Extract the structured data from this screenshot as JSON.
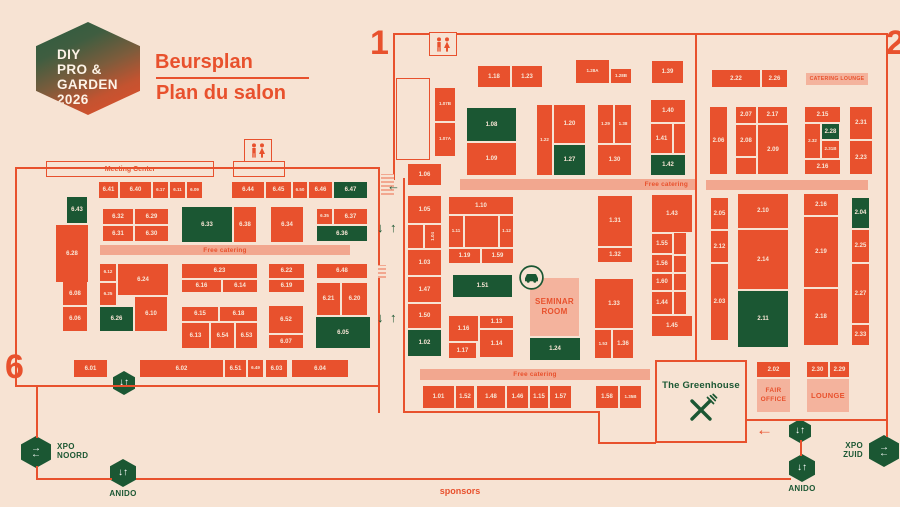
{
  "logo": {
    "lines": [
      "DIY",
      "PRO &",
      "GARDEN",
      "2026"
    ]
  },
  "title": {
    "primary": "Beursplan",
    "secondary": "Plan du salon"
  },
  "markers": {
    "one": "1",
    "two": "2",
    "six": "6"
  },
  "misc": {
    "sponsors": "sponsors"
  },
  "greenhouse": {
    "title": "The Greenhouse"
  },
  "colors": {
    "background": "#f7e3d3",
    "booth_orange": "#e8512d",
    "booth_green": "#1b5733",
    "strip_pink": "#f2a78f",
    "panel_pink": "#f4b39d",
    "accent_green": "#1b5733"
  },
  "booths": [
    {
      "l": "1.18",
      "x": 478,
      "y": 66,
      "w": 32,
      "h": 21
    },
    {
      "l": "1.23",
      "x": 512,
      "y": 66,
      "w": 30,
      "h": 21
    },
    {
      "l": "1.28A",
      "x": 576,
      "y": 60,
      "w": 33,
      "h": 23
    },
    {
      "l": "1.28B",
      "x": 611,
      "y": 69,
      "w": 20,
      "h": 14
    },
    {
      "l": "1.39",
      "x": 652,
      "y": 61,
      "w": 31,
      "h": 22
    },
    {
      "l": "1.07B",
      "x": 435,
      "y": 88,
      "w": 20,
      "h": 33
    },
    {
      "l": "1.07A",
      "x": 435,
      "y": 123,
      "w": 20,
      "h": 33
    },
    {
      "l": "1.06",
      "x": 408,
      "y": 164,
      "w": 33,
      "h": 21
    },
    {
      "l": "1.08",
      "x": 467,
      "y": 108,
      "w": 49,
      "h": 33,
      "c": "g"
    },
    {
      "l": "1.09",
      "x": 467,
      "y": 143,
      "w": 49,
      "h": 32
    },
    {
      "l": "1.22",
      "x": 537,
      "y": 105,
      "w": 15,
      "h": 70
    },
    {
      "l": "1.20",
      "x": 554,
      "y": 105,
      "w": 31,
      "h": 38
    },
    {
      "l": "1.27",
      "x": 554,
      "y": 145,
      "w": 31,
      "h": 30,
      "c": "g"
    },
    {
      "l": "1.29",
      "x": 598,
      "y": 105,
      "w": 15,
      "h": 38
    },
    {
      "l": "1.38",
      "x": 615,
      "y": 105,
      "w": 16,
      "h": 38
    },
    {
      "l": "1.30",
      "x": 598,
      "y": 145,
      "w": 33,
      "h": 30
    },
    {
      "l": "1.40",
      "x": 651,
      "y": 100,
      "w": 34,
      "h": 22
    },
    {
      "l": "1.41",
      "x": 651,
      "y": 124,
      "w": 21,
      "h": 29
    },
    {
      "x": 674,
      "y": 124,
      "w": 11,
      "h": 29
    },
    {
      "l": "1.42",
      "x": 651,
      "y": 155,
      "w": 34,
      "h": 20,
      "c": "g"
    },
    {
      "l": "1.05",
      "x": 408,
      "y": 196,
      "w": 33,
      "h": 27
    },
    {
      "x": 408,
      "y": 225,
      "w": 15,
      "h": 23
    },
    {
      "l": "1.04",
      "x": 425,
      "y": 225,
      "w": 16,
      "h": 23,
      "r": true
    },
    {
      "l": "1.03",
      "x": 408,
      "y": 250,
      "w": 33,
      "h": 25
    },
    {
      "l": "1.47",
      "x": 408,
      "y": 277,
      "w": 33,
      "h": 25
    },
    {
      "l": "1.50",
      "x": 408,
      "y": 304,
      "w": 33,
      "h": 24
    },
    {
      "l": "1.02",
      "x": 408,
      "y": 330,
      "w": 33,
      "h": 26,
      "c": "g"
    },
    {
      "l": "1.10",
      "x": 449,
      "y": 197,
      "w": 64,
      "h": 17
    },
    {
      "l": "1.11",
      "x": 449,
      "y": 216,
      "w": 14,
      "h": 31
    },
    {
      "x": 465,
      "y": 216,
      "w": 33,
      "h": 31
    },
    {
      "l": "1.12",
      "x": 500,
      "y": 216,
      "w": 13,
      "h": 31
    },
    {
      "l": "1.19",
      "x": 449,
      "y": 249,
      "w": 31,
      "h": 14
    },
    {
      "l": "1.59",
      "x": 482,
      "y": 249,
      "w": 31,
      "h": 14
    },
    {
      "l": "1.51",
      "x": 453,
      "y": 275,
      "w": 59,
      "h": 22,
      "c": "g"
    },
    {
      "l": "1.16",
      "x": 449,
      "y": 316,
      "w": 29,
      "h": 25
    },
    {
      "l": "1.13",
      "x": 480,
      "y": 316,
      "w": 33,
      "h": 12
    },
    {
      "l": "1.14",
      "x": 480,
      "y": 330,
      "w": 33,
      "h": 27
    },
    {
      "l": "1.17",
      "x": 449,
      "y": 343,
      "w": 27,
      "h": 15
    },
    {
      "l": "1.24",
      "x": 530,
      "y": 338,
      "w": 50,
      "h": 22,
      "c": "g"
    },
    {
      "l": "1.31",
      "x": 598,
      "y": 196,
      "w": 34,
      "h": 50
    },
    {
      "l": "1.32",
      "x": 598,
      "y": 248,
      "w": 34,
      "h": 14
    },
    {
      "l": "1.33",
      "x": 595,
      "y": 279,
      "w": 38,
      "h": 49
    },
    {
      "l": "1.53",
      "x": 595,
      "y": 330,
      "w": 16,
      "h": 28
    },
    {
      "l": "1.36",
      "x": 613,
      "y": 330,
      "w": 20,
      "h": 28
    },
    {
      "l": "1.43",
      "x": 652,
      "y": 195,
      "w": 40,
      "h": 37
    },
    {
      "l": "1.55",
      "x": 652,
      "y": 234,
      "w": 20,
      "h": 19
    },
    {
      "x": 674,
      "y": 233,
      "w": 12,
      "h": 21
    },
    {
      "l": "1.56",
      "x": 652,
      "y": 255,
      "w": 20,
      "h": 17
    },
    {
      "x": 674,
      "y": 256,
      "w": 12,
      "h": 16
    },
    {
      "l": "1.60",
      "x": 652,
      "y": 274,
      "w": 20,
      "h": 16
    },
    {
      "x": 674,
      "y": 274,
      "w": 12,
      "h": 16
    },
    {
      "l": "1.44",
      "x": 652,
      "y": 292,
      "w": 20,
      "h": 22
    },
    {
      "x": 674,
      "y": 292,
      "w": 12,
      "h": 22
    },
    {
      "l": "1.45",
      "x": 652,
      "y": 316,
      "w": 40,
      "h": 20
    },
    {
      "l": "1.01",
      "x": 423,
      "y": 386,
      "w": 31,
      "h": 22
    },
    {
      "l": "1.52",
      "x": 456,
      "y": 386,
      "w": 18,
      "h": 22
    },
    {
      "l": "1.48",
      "x": 477,
      "y": 386,
      "w": 28,
      "h": 22
    },
    {
      "l": "1.46",
      "x": 507,
      "y": 386,
      "w": 21,
      "h": 22
    },
    {
      "l": "1.15",
      "x": 530,
      "y": 386,
      "w": 18,
      "h": 22
    },
    {
      "l": "1.57",
      "x": 550,
      "y": 386,
      "w": 21,
      "h": 22
    },
    {
      "l": "1.58",
      "x": 596,
      "y": 386,
      "w": 22,
      "h": 22
    },
    {
      "l": "1.35B",
      "x": 620,
      "y": 386,
      "w": 21,
      "h": 22
    },
    {
      "l": "2.22",
      "x": 712,
      "y": 70,
      "w": 48,
      "h": 17
    },
    {
      "l": "2.26",
      "x": 762,
      "y": 70,
      "w": 25,
      "h": 17
    },
    {
      "l": "2.06",
      "x": 710,
      "y": 107,
      "w": 17,
      "h": 67
    },
    {
      "l": "2.07",
      "x": 736,
      "y": 107,
      "w": 20,
      "h": 16
    },
    {
      "l": "2.17",
      "x": 758,
      "y": 107,
      "w": 29,
      "h": 16
    },
    {
      "l": "2.08",
      "x": 736,
      "y": 125,
      "w": 20,
      "h": 31
    },
    {
      "l": "2.09",
      "x": 758,
      "y": 125,
      "w": 30,
      "h": 49
    },
    {
      "x": 736,
      "y": 158,
      "w": 20,
      "h": 16
    },
    {
      "l": "2.15",
      "x": 805,
      "y": 107,
      "w": 35,
      "h": 15
    },
    {
      "l": "2.32",
      "x": 805,
      "y": 124,
      "w": 15,
      "h": 34
    },
    {
      "l": "2.28",
      "x": 822,
      "y": 124,
      "w": 17,
      "h": 15,
      "c": "g"
    },
    {
      "l": "2.31B",
      "x": 822,
      "y": 141,
      "w": 17,
      "h": 17
    },
    {
      "l": "2.16",
      "x": 805,
      "y": 160,
      "w": 35,
      "h": 14
    },
    {
      "l": "2.31",
      "x": 850,
      "y": 107,
      "w": 22,
      "h": 32
    },
    {
      "l": "2.23",
      "x": 850,
      "y": 141,
      "w": 22,
      "h": 33
    },
    {
      "l": "2.05",
      "x": 711,
      "y": 198,
      "w": 17,
      "h": 31
    },
    {
      "l": "2.12",
      "x": 711,
      "y": 231,
      "w": 17,
      "h": 31
    },
    {
      "l": "2.03",
      "x": 711,
      "y": 264,
      "w": 17,
      "h": 76
    },
    {
      "l": "2.10",
      "x": 738,
      "y": 194,
      "w": 50,
      "h": 34
    },
    {
      "l": "2.14",
      "x": 738,
      "y": 230,
      "w": 50,
      "h": 59
    },
    {
      "l": "2.11",
      "x": 738,
      "y": 291,
      "w": 50,
      "h": 56,
      "c": "g"
    },
    {
      "l": "2.16",
      "x": 804,
      "y": 194,
      "w": 34,
      "h": 21
    },
    {
      "l": "2.19",
      "x": 804,
      "y": 217,
      "w": 34,
      "h": 70
    },
    {
      "l": "2.18",
      "x": 804,
      "y": 289,
      "w": 34,
      "h": 56
    },
    {
      "l": "2.04",
      "x": 852,
      "y": 198,
      "w": 17,
      "h": 30,
      "c": "g"
    },
    {
      "l": "2.25",
      "x": 852,
      "y": 230,
      "w": 17,
      "h": 32
    },
    {
      "l": "2.27",
      "x": 852,
      "y": 264,
      "w": 17,
      "h": 59
    },
    {
      "l": "2.33",
      "x": 852,
      "y": 325,
      "w": 17,
      "h": 20
    },
    {
      "l": "2.02",
      "x": 757,
      "y": 362,
      "w": 33,
      "h": 15
    },
    {
      "l": "2.30",
      "x": 807,
      "y": 362,
      "w": 21,
      "h": 15
    },
    {
      "l": "2.29",
      "x": 830,
      "y": 362,
      "w": 19,
      "h": 15
    },
    {
      "l": "6.41",
      "x": 99,
      "y": 182,
      "w": 19,
      "h": 16
    },
    {
      "l": "6.40",
      "x": 120,
      "y": 182,
      "w": 31,
      "h": 16
    },
    {
      "l": "6.17",
      "x": 153,
      "y": 182,
      "w": 15,
      "h": 16
    },
    {
      "l": "6.11",
      "x": 170,
      "y": 182,
      "w": 15,
      "h": 16
    },
    {
      "l": "6.09",
      "x": 187,
      "y": 182,
      "w": 15,
      "h": 16
    },
    {
      "l": "6.44",
      "x": 232,
      "y": 182,
      "w": 32,
      "h": 16
    },
    {
      "l": "6.45",
      "x": 266,
      "y": 182,
      "w": 25,
      "h": 16
    },
    {
      "l": "6.50",
      "x": 293,
      "y": 182,
      "w": 14,
      "h": 16
    },
    {
      "l": "6.46",
      "x": 309,
      "y": 182,
      "w": 23,
      "h": 16
    },
    {
      "l": "6.47",
      "x": 334,
      "y": 182,
      "w": 33,
      "h": 16,
      "c": "g"
    },
    {
      "l": "6.43",
      "x": 67,
      "y": 197,
      "w": 20,
      "h": 26,
      "c": "g"
    },
    {
      "l": "6.28",
      "x": 56,
      "y": 225,
      "w": 32,
      "h": 57
    },
    {
      "l": "6.32",
      "x": 103,
      "y": 209,
      "w": 30,
      "h": 15
    },
    {
      "l": "6.29",
      "x": 135,
      "y": 209,
      "w": 33,
      "h": 15
    },
    {
      "l": "6.31",
      "x": 103,
      "y": 226,
      "w": 30,
      "h": 15
    },
    {
      "l": "6.30",
      "x": 135,
      "y": 226,
      "w": 33,
      "h": 15
    },
    {
      "l": "6.33",
      "x": 182,
      "y": 207,
      "w": 50,
      "h": 35,
      "c": "g"
    },
    {
      "l": "6.38",
      "x": 234,
      "y": 207,
      "w": 22,
      "h": 35
    },
    {
      "l": "6.34",
      "x": 271,
      "y": 207,
      "w": 32,
      "h": 35
    },
    {
      "l": "6.35",
      "x": 317,
      "y": 209,
      "w": 15,
      "h": 15
    },
    {
      "l": "6.37",
      "x": 334,
      "y": 209,
      "w": 33,
      "h": 15
    },
    {
      "l": "6.36",
      "x": 317,
      "y": 226,
      "w": 50,
      "h": 15,
      "c": "g"
    },
    {
      "l": "6.08",
      "x": 63,
      "y": 282,
      "w": 24,
      "h": 23
    },
    {
      "l": "6.06",
      "x": 63,
      "y": 307,
      "w": 24,
      "h": 24
    },
    {
      "l": "6.12",
      "x": 100,
      "y": 264,
      "w": 16,
      "h": 17
    },
    {
      "l": "6.24",
      "x": 118,
      "y": 264,
      "w": 50,
      "h": 31
    },
    {
      "l": "6.25",
      "x": 100,
      "y": 283,
      "w": 16,
      "h": 22
    },
    {
      "l": "6.26",
      "x": 100,
      "y": 307,
      "w": 33,
      "h": 24,
      "c": "g"
    },
    {
      "l": "6.10",
      "x": 135,
      "y": 297,
      "w": 32,
      "h": 34
    },
    {
      "l": "6.23",
      "x": 182,
      "y": 264,
      "w": 75,
      "h": 14
    },
    {
      "l": "6.16",
      "x": 182,
      "y": 280,
      "w": 39,
      "h": 12
    },
    {
      "l": "6.14",
      "x": 223,
      "y": 280,
      "w": 34,
      "h": 12
    },
    {
      "l": "6.15",
      "x": 182,
      "y": 307,
      "w": 36,
      "h": 14
    },
    {
      "l": "6.18",
      "x": 220,
      "y": 307,
      "w": 37,
      "h": 14
    },
    {
      "l": "6.13",
      "x": 182,
      "y": 323,
      "w": 27,
      "h": 25
    },
    {
      "l": "6.54",
      "x": 211,
      "y": 323,
      "w": 23,
      "h": 25
    },
    {
      "l": "6.53",
      "x": 236,
      "y": 323,
      "w": 21,
      "h": 25
    },
    {
      "l": "6.22",
      "x": 269,
      "y": 264,
      "w": 35,
      "h": 14
    },
    {
      "l": "6.19",
      "x": 269,
      "y": 280,
      "w": 35,
      "h": 12
    },
    {
      "l": "6.52",
      "x": 269,
      "y": 306,
      "w": 34,
      "h": 27
    },
    {
      "l": "6.07",
      "x": 269,
      "y": 335,
      "w": 34,
      "h": 13
    },
    {
      "l": "6.48",
      "x": 317,
      "y": 264,
      "w": 50,
      "h": 14
    },
    {
      "l": "6.21",
      "x": 317,
      "y": 283,
      "w": 23,
      "h": 32
    },
    {
      "l": "6.20",
      "x": 342,
      "y": 283,
      "w": 25,
      "h": 32
    },
    {
      "l": "6.05",
      "x": 316,
      "y": 317,
      "w": 54,
      "h": 31,
      "c": "g"
    },
    {
      "l": "6.01",
      "x": 74,
      "y": 360,
      "w": 33,
      "h": 17
    },
    {
      "l": "6.02",
      "x": 140,
      "y": 360,
      "w": 83,
      "h": 17
    },
    {
      "l": "6.51",
      "x": 225,
      "y": 360,
      "w": 21,
      "h": 17
    },
    {
      "l": "6.49",
      "x": 248,
      "y": 360,
      "w": 15,
      "h": 17
    },
    {
      "l": "6.03",
      "x": 266,
      "y": 360,
      "w": 21,
      "h": 17
    },
    {
      "l": "6.04",
      "x": 292,
      "y": 360,
      "w": 56,
      "h": 17
    }
  ],
  "strips": [
    {
      "name": "free-catering-hall6",
      "text": "Free catering",
      "x": 100,
      "y": 245,
      "w": 250,
      "h": 10,
      "align": "center"
    },
    {
      "name": "free-catering-hall1-top",
      "text": "Free catering",
      "x": 460,
      "y": 179,
      "w": 236,
      "h": 11,
      "align": "right"
    },
    {
      "name": "catering-strip-hall2",
      "text": "",
      "x": 706,
      "y": 180,
      "w": 162,
      "h": 10,
      "align": "center"
    },
    {
      "name": "free-catering-hall1-bottom",
      "text": "Free catering",
      "x": 420,
      "y": 369,
      "w": 230,
      "h": 11,
      "align": "center"
    }
  ],
  "panels": [
    {
      "name": "seminar-room",
      "lines": [
        "SEMINAR",
        "ROOM"
      ],
      "x": 530,
      "y": 278,
      "w": 49,
      "h": 58,
      "fs": 8
    },
    {
      "name": "fair-office",
      "lines": [
        "FAIR",
        "OFFICE"
      ],
      "x": 757,
      "y": 379,
      "w": 33,
      "h": 33,
      "fs": 6.5
    },
    {
      "name": "lounge",
      "lines": [
        "LOUNGE"
      ],
      "x": 807,
      "y": 379,
      "w": 42,
      "h": 33,
      "fs": 7.5
    },
    {
      "name": "catering-lounge",
      "lines": [
        "CATERING LOUNGE"
      ],
      "x": 806,
      "y": 73,
      "w": 62,
      "h": 12,
      "fs": 5.2
    }
  ],
  "outlines": [
    {
      "name": "meeting-center",
      "text": "Meeting Center",
      "x": 46,
      "y": 161,
      "w": 168,
      "h": 16,
      "fs": 7
    },
    {
      "name": "meeting-center-annex",
      "text": "",
      "x": 233,
      "y": 161,
      "w": 52,
      "h": 16
    },
    {
      "name": "entrance-box",
      "text": "",
      "x": 396,
      "y": 78,
      "w": 34,
      "h": 82
    }
  ],
  "badges": [
    {
      "name": "stairs-hall6",
      "type": "ud",
      "x": 113,
      "y": 371,
      "w": 22,
      "h": 24
    },
    {
      "name": "xpo-noord",
      "type": "lr",
      "x": 21,
      "y": 436,
      "w": 30,
      "h": 32,
      "lines": [
        "XPO",
        "NOORD"
      ],
      "labelpos": "right"
    },
    {
      "name": "anido-west",
      "type": "ud",
      "x": 110,
      "y": 459,
      "w": 26,
      "h": 28,
      "lines": [
        "ANIDO"
      ],
      "labelpos": "below"
    },
    {
      "name": "stairs-hall2",
      "type": "ud",
      "x": 789,
      "y": 419,
      "w": 22,
      "h": 24
    },
    {
      "name": "anido-east",
      "type": "ud",
      "x": 789,
      "y": 454,
      "w": 26,
      "h": 28,
      "lines": [
        "ANIDO"
      ],
      "labelpos": "below"
    },
    {
      "name": "xpo-zuid",
      "type": "lr",
      "x": 869,
      "y": 435,
      "w": 30,
      "h": 32,
      "lines": [
        "XPO",
        "ZUID"
      ],
      "labelpos": "left"
    }
  ]
}
